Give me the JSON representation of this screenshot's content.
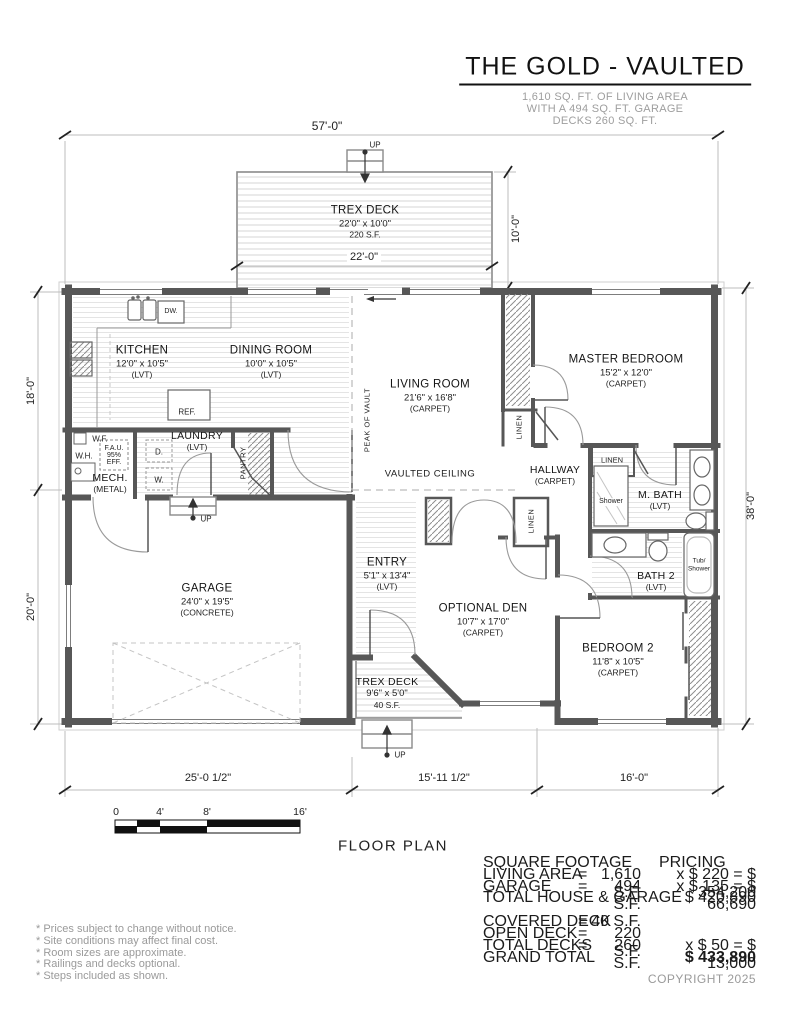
{
  "header": {
    "title": "THE GOLD - VAULTED",
    "subtitle": [
      "1,610 SQ. FT. OF LIVING AREA",
      "WITH A 494 SQ. FT. GARAGE",
      "DECKS 260 SQ. FT."
    ]
  },
  "plan_label": "FLOOR PLAN",
  "copyright": "COPYRIGHT 2025",
  "dims": {
    "overall_width": "57'-0\"",
    "deck_width": "22'-0\"",
    "deck_depth": "10'-0\"",
    "left_upper": "18'-0\"",
    "left_lower": "20'-0\"",
    "right_height": "38'-0\"",
    "bottom_left": "25'-0 1/2\"",
    "bottom_middle": "15'-11 1/2\"",
    "bottom_right": "16'-0\""
  },
  "rooms": [
    {
      "name": "TREX DECK",
      "size": "22'0\" x 10'0\"",
      "note": "220 S.F."
    },
    {
      "name": "KITCHEN",
      "size": "12'0\" x 10'5\"",
      "note": "(LVT)"
    },
    {
      "name": "DINING ROOM",
      "size": "10'0\" x 10'5\"",
      "note": "(LVT)"
    },
    {
      "name": "LIVING ROOM",
      "size": "21'6\" x 16'8\"",
      "note": "(CARPET)"
    },
    {
      "name": "MASTER BEDROOM",
      "size": "15'2\" x 12'0\"",
      "note": "(CARPET)"
    },
    {
      "name": "LAUNDRY",
      "note": "(LVT)"
    },
    {
      "name": "MECH.",
      "note": "(METAL)"
    },
    {
      "name": "HALLWAY",
      "note": "(CARPET)"
    },
    {
      "name": "M. BATH",
      "note": "(LVT)"
    },
    {
      "name": "BATH 2",
      "note": "(LVT)"
    },
    {
      "name": "GARAGE",
      "size": "24'0\" x 19'5\"",
      "note": "(CONCRETE)"
    },
    {
      "name": "ENTRY",
      "size": "5'1\" x 13'4\"",
      "note": "(LVT)"
    },
    {
      "name": "OPTIONAL DEN",
      "size": "10'7\" x 17'0\"",
      "note": "(CARPET)"
    },
    {
      "name": "BEDROOM 2",
      "size": "11'8\" x 10'5\"",
      "note": "(CARPET)"
    },
    {
      "name": "TREX DECK",
      "size": "9'6\" x 5'0\"",
      "note": "40 S.F."
    }
  ],
  "labels": {
    "up": "UP",
    "dw": "DW.",
    "ref": "REF.",
    "wf": "W.F.",
    "wh": "W.H.",
    "fau1": "F.A.U.",
    "fau2": "95%",
    "fau3": "EFF.",
    "d": "D.",
    "w": "W.",
    "pantry": "PANTRY",
    "linen": "LINEN",
    "peak_of_vault": "PEAK OF VAULT",
    "vaulted_ceiling": "VAULTED CEILING",
    "shower": "Shower",
    "tub1": "Tub/",
    "tub2": "Shower"
  },
  "scale_bar": {
    "ticks": [
      "0",
      "4'",
      "8'",
      "16'"
    ]
  },
  "table": {
    "sf_header": "SQUARE FOOTAGE",
    "pricing_header": "PRICING",
    "rows": [
      {
        "label": "LIVING AREA",
        "eq": "=",
        "value": "1,610 S.F.",
        "price": "x $ 220 = $ 354,200"
      },
      {
        "label": "GARAGE",
        "eq": "=",
        "value": "494 S.F.",
        "price": "x $ 135 = $ 66,690"
      },
      {
        "label": "TOTAL HOUSE & GARAGE",
        "price": "$ 420,890"
      },
      {
        "label": "COVERED DECK",
        "eq": "=",
        "value": "40 S.F."
      },
      {
        "label": "OPEN DECK",
        "eq": "=",
        "value": "220 S.F."
      },
      {
        "label": "TOTAL DECKS",
        "eq": "=",
        "value": "260 S.F.",
        "price": "x $ 50 = $ 13,000"
      },
      {
        "label": "GRAND TOTAL",
        "price": "$ 433,890"
      }
    ]
  },
  "notes": [
    "* Prices subject to change without notice.",
    "* Site conditions may affect final cost.",
    "* Room sizes are approximate.",
    "* Railings and decks optional.",
    "* Steps included as shown."
  ]
}
